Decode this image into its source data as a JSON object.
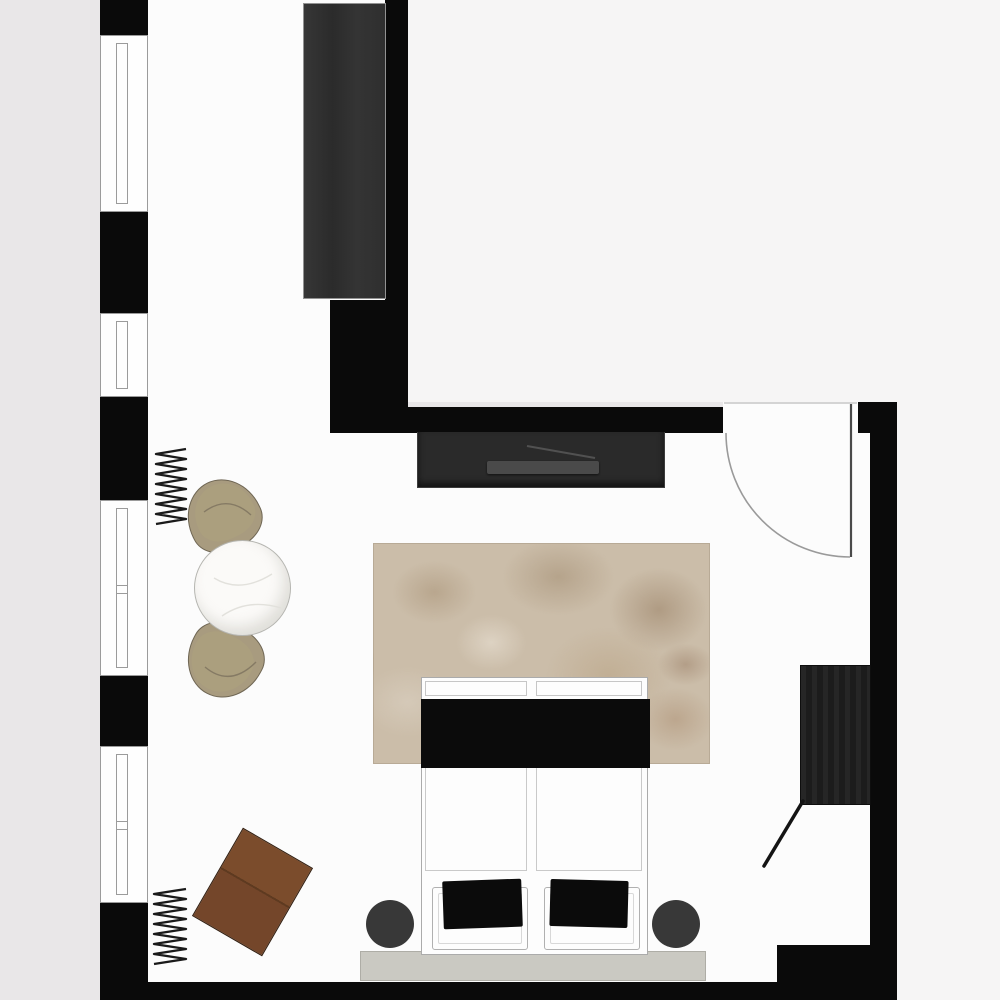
{
  "scene": {
    "kind": "floor-plan",
    "room": "bedroom-studio",
    "orientation": "top-down"
  },
  "colors": {
    "background": "#e9e7e8",
    "background_light": "#f6f5f5",
    "floor": "#fcfcfc",
    "wall": "#0a0a0a",
    "window_frame": "#9b9b9b",
    "wardrobe": "#2f2f2f",
    "tv_console": "#2a2a2a",
    "television": "#4a4a4a",
    "rug": "#cbbda9",
    "bed": "#fdfdfd",
    "bed_outline": "#ababab",
    "throw": "#0b0b0b",
    "bench": "#cac9c2",
    "nightstand": "#383838",
    "table": "#fbfaf8",
    "chair": "#a89b7f",
    "desk": "#74462a",
    "closet": "#212121",
    "line": "#9a9a9a",
    "radiator": "#1a1a1a"
  },
  "elements": {
    "walls": [
      "left-wall",
      "upper-vertical-wall",
      "wall-pier",
      "top-wall",
      "door-jamb",
      "right-wall",
      "bottom-wall",
      "bottom-right-wall-block"
    ],
    "windows": [
      "window-1",
      "window-2",
      "window-3",
      "window-4"
    ],
    "door": "entry-door-with-swing-arc",
    "furniture": [
      "tall-wardrobe",
      "tv-console",
      "television",
      "area-rug",
      "double-bed",
      "throw-blanket",
      "pillow-left",
      "pillow-right",
      "foot-bench",
      "nightstand-left",
      "nightstand-right",
      "round-table",
      "armchair-north",
      "armchair-south",
      "writing-desk",
      "radiator-north",
      "radiator-south",
      "wall-closet"
    ]
  }
}
